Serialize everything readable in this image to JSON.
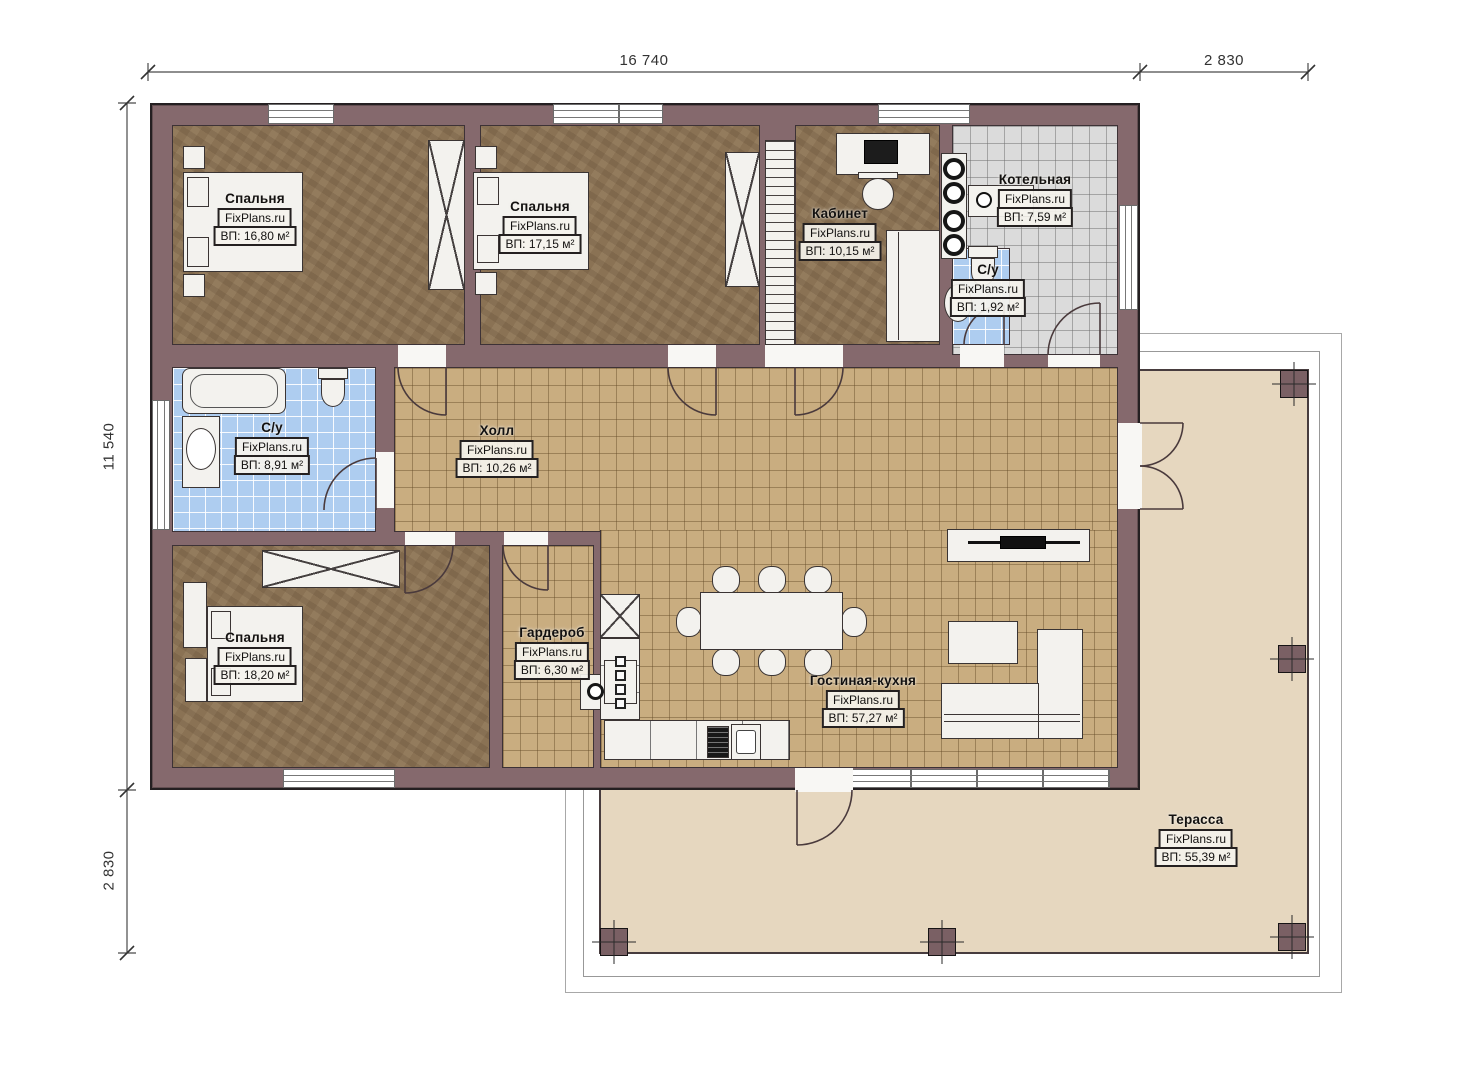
{
  "plan": {
    "brand": "FixPlans.ru",
    "dimensions": {
      "width_main": "16 740",
      "width_right": "2 830",
      "height_main": "11 540",
      "height_bottom": "2 830"
    },
    "rooms": {
      "bedroom1": {
        "name": "Спальня",
        "area": "ВП: 16,80 м²"
      },
      "bedroom2": {
        "name": "Спальня",
        "area": "ВП: 17,15 м²"
      },
      "office": {
        "name": "Кабинет",
        "area": "ВП: 10,15 м²"
      },
      "boiler": {
        "name": "Котельная",
        "area": "ВП: 7,59 м²"
      },
      "wc_small": {
        "name": "С/у",
        "area": "ВП: 1,92 м²"
      },
      "bathroom": {
        "name": "С/у",
        "area": "ВП: 8,91 м²"
      },
      "hall": {
        "name": "Холл",
        "area": "ВП: 10,26 м²"
      },
      "bedroom3": {
        "name": "Спальня",
        "area": "ВП: 18,20 м²"
      },
      "wardrobe": {
        "name": "Гардероб",
        "area": "ВП: 6,30 м²"
      },
      "living": {
        "name": "Гостиная-кухня",
        "area": "ВП: 57,27 м²"
      },
      "terrace": {
        "name": "Терасса",
        "area": "ВП: 55,39 м²"
      }
    },
    "colors": {
      "wall": "#85696d",
      "floor_wood": "#8a7254",
      "floor_tile": "#c9ad80",
      "tile_blue": "#aecdf0",
      "tile_grey": "#dbdbdb",
      "terrace_floor": "#e6d7bf"
    }
  }
}
